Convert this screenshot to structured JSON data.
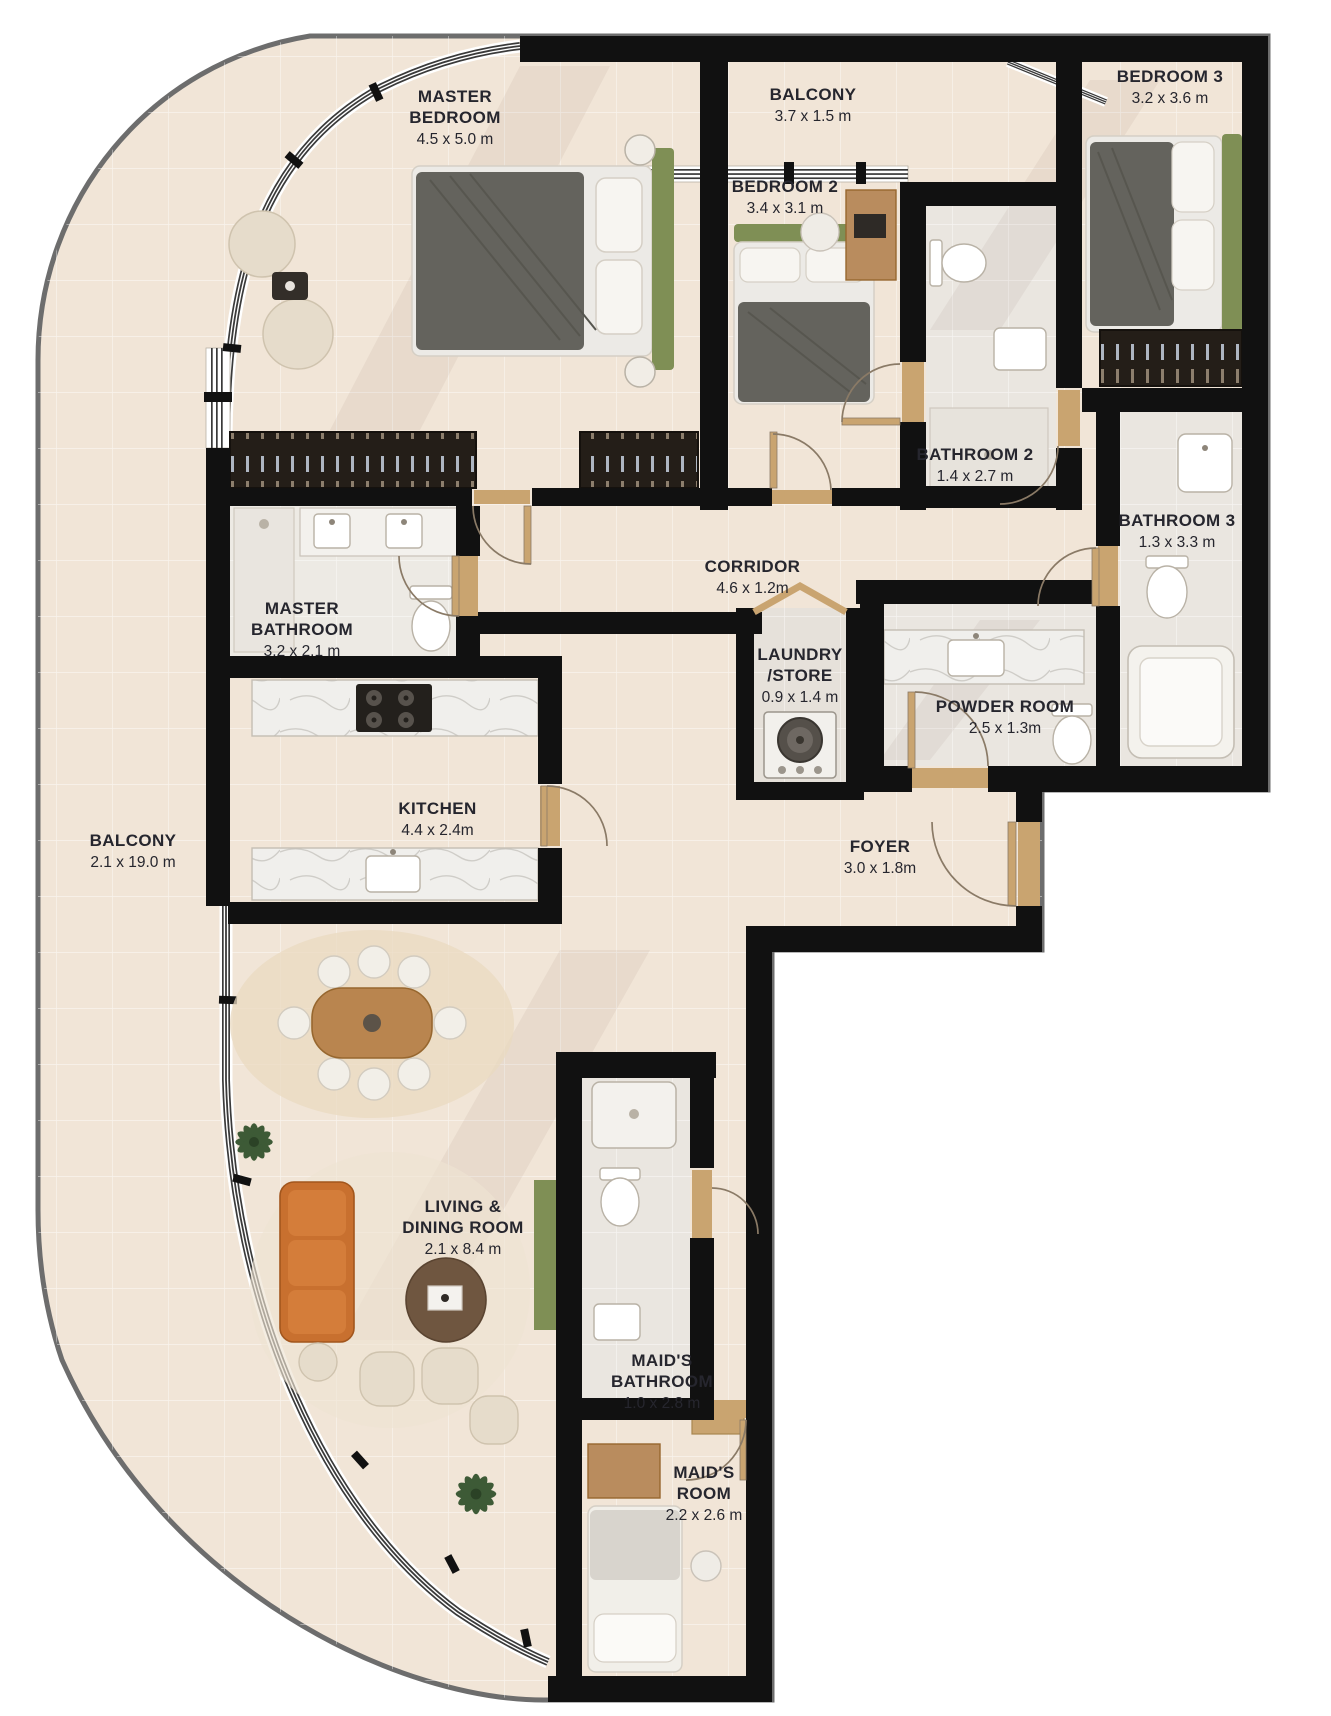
{
  "plan": {
    "title": "apartment-floor-plan",
    "rooms": [
      {
        "id": "master-bedroom",
        "name": "MASTER BEDROOM",
        "dims": "4.5 x 5.0 m"
      },
      {
        "id": "balcony-top",
        "name": "BALCONY",
        "dims": "3.7 x 1.5 m"
      },
      {
        "id": "bedroom-3",
        "name": "BEDROOM 3",
        "dims": "3.2 x 3.6 m"
      },
      {
        "id": "bedroom-2",
        "name": "BEDROOM 2",
        "dims": "3.4 x 3.1 m"
      },
      {
        "id": "bathroom-2",
        "name": "BATHROOM 2",
        "dims": "1.4 x 2.7 m"
      },
      {
        "id": "bathroom-3",
        "name": "BATHROOM 3",
        "dims": "1.3 x 3.3 m"
      },
      {
        "id": "corridor",
        "name": "CORRIDOR",
        "dims": "4.6 x 1.2m"
      },
      {
        "id": "master-bathroom",
        "name": "MASTER BATHROOM",
        "dims": "3.2 x 2.1 m"
      },
      {
        "id": "laundry-store",
        "name": "LAUNDRY /STORE",
        "dims": "0.9 x 1.4 m"
      },
      {
        "id": "powder-room",
        "name": "POWDER ROOM",
        "dims": "2.5 x 1.3m"
      },
      {
        "id": "kitchen",
        "name": "KITCHEN",
        "dims": "4.4 x 2.4m"
      },
      {
        "id": "foyer",
        "name": "FOYER",
        "dims": "3.0 x 1.8m"
      },
      {
        "id": "balcony-left",
        "name": "BALCONY",
        "dims": "2.1 x 19.0 m"
      },
      {
        "id": "living-dining",
        "name": "LIVING & DINING ROOM",
        "dims": "2.1 x 8.4 m"
      },
      {
        "id": "maids-bathroom",
        "name": "MAID'S BATHROOM",
        "dims": "1.0 x 2.8 m"
      },
      {
        "id": "maids-room",
        "name": "MAID'S ROOM",
        "dims": "2.2 x 2.6 m"
      }
    ],
    "colors": {
      "floor": "#f1e5d7",
      "bathroom_floor": "#eae6e0",
      "wall": "#111111",
      "outline": "#6d6d6d",
      "wood": "#c9a470",
      "headboard_green": "#7f8f55",
      "sofa_orange": "#c8702f",
      "label_text": "#26262e"
    }
  }
}
